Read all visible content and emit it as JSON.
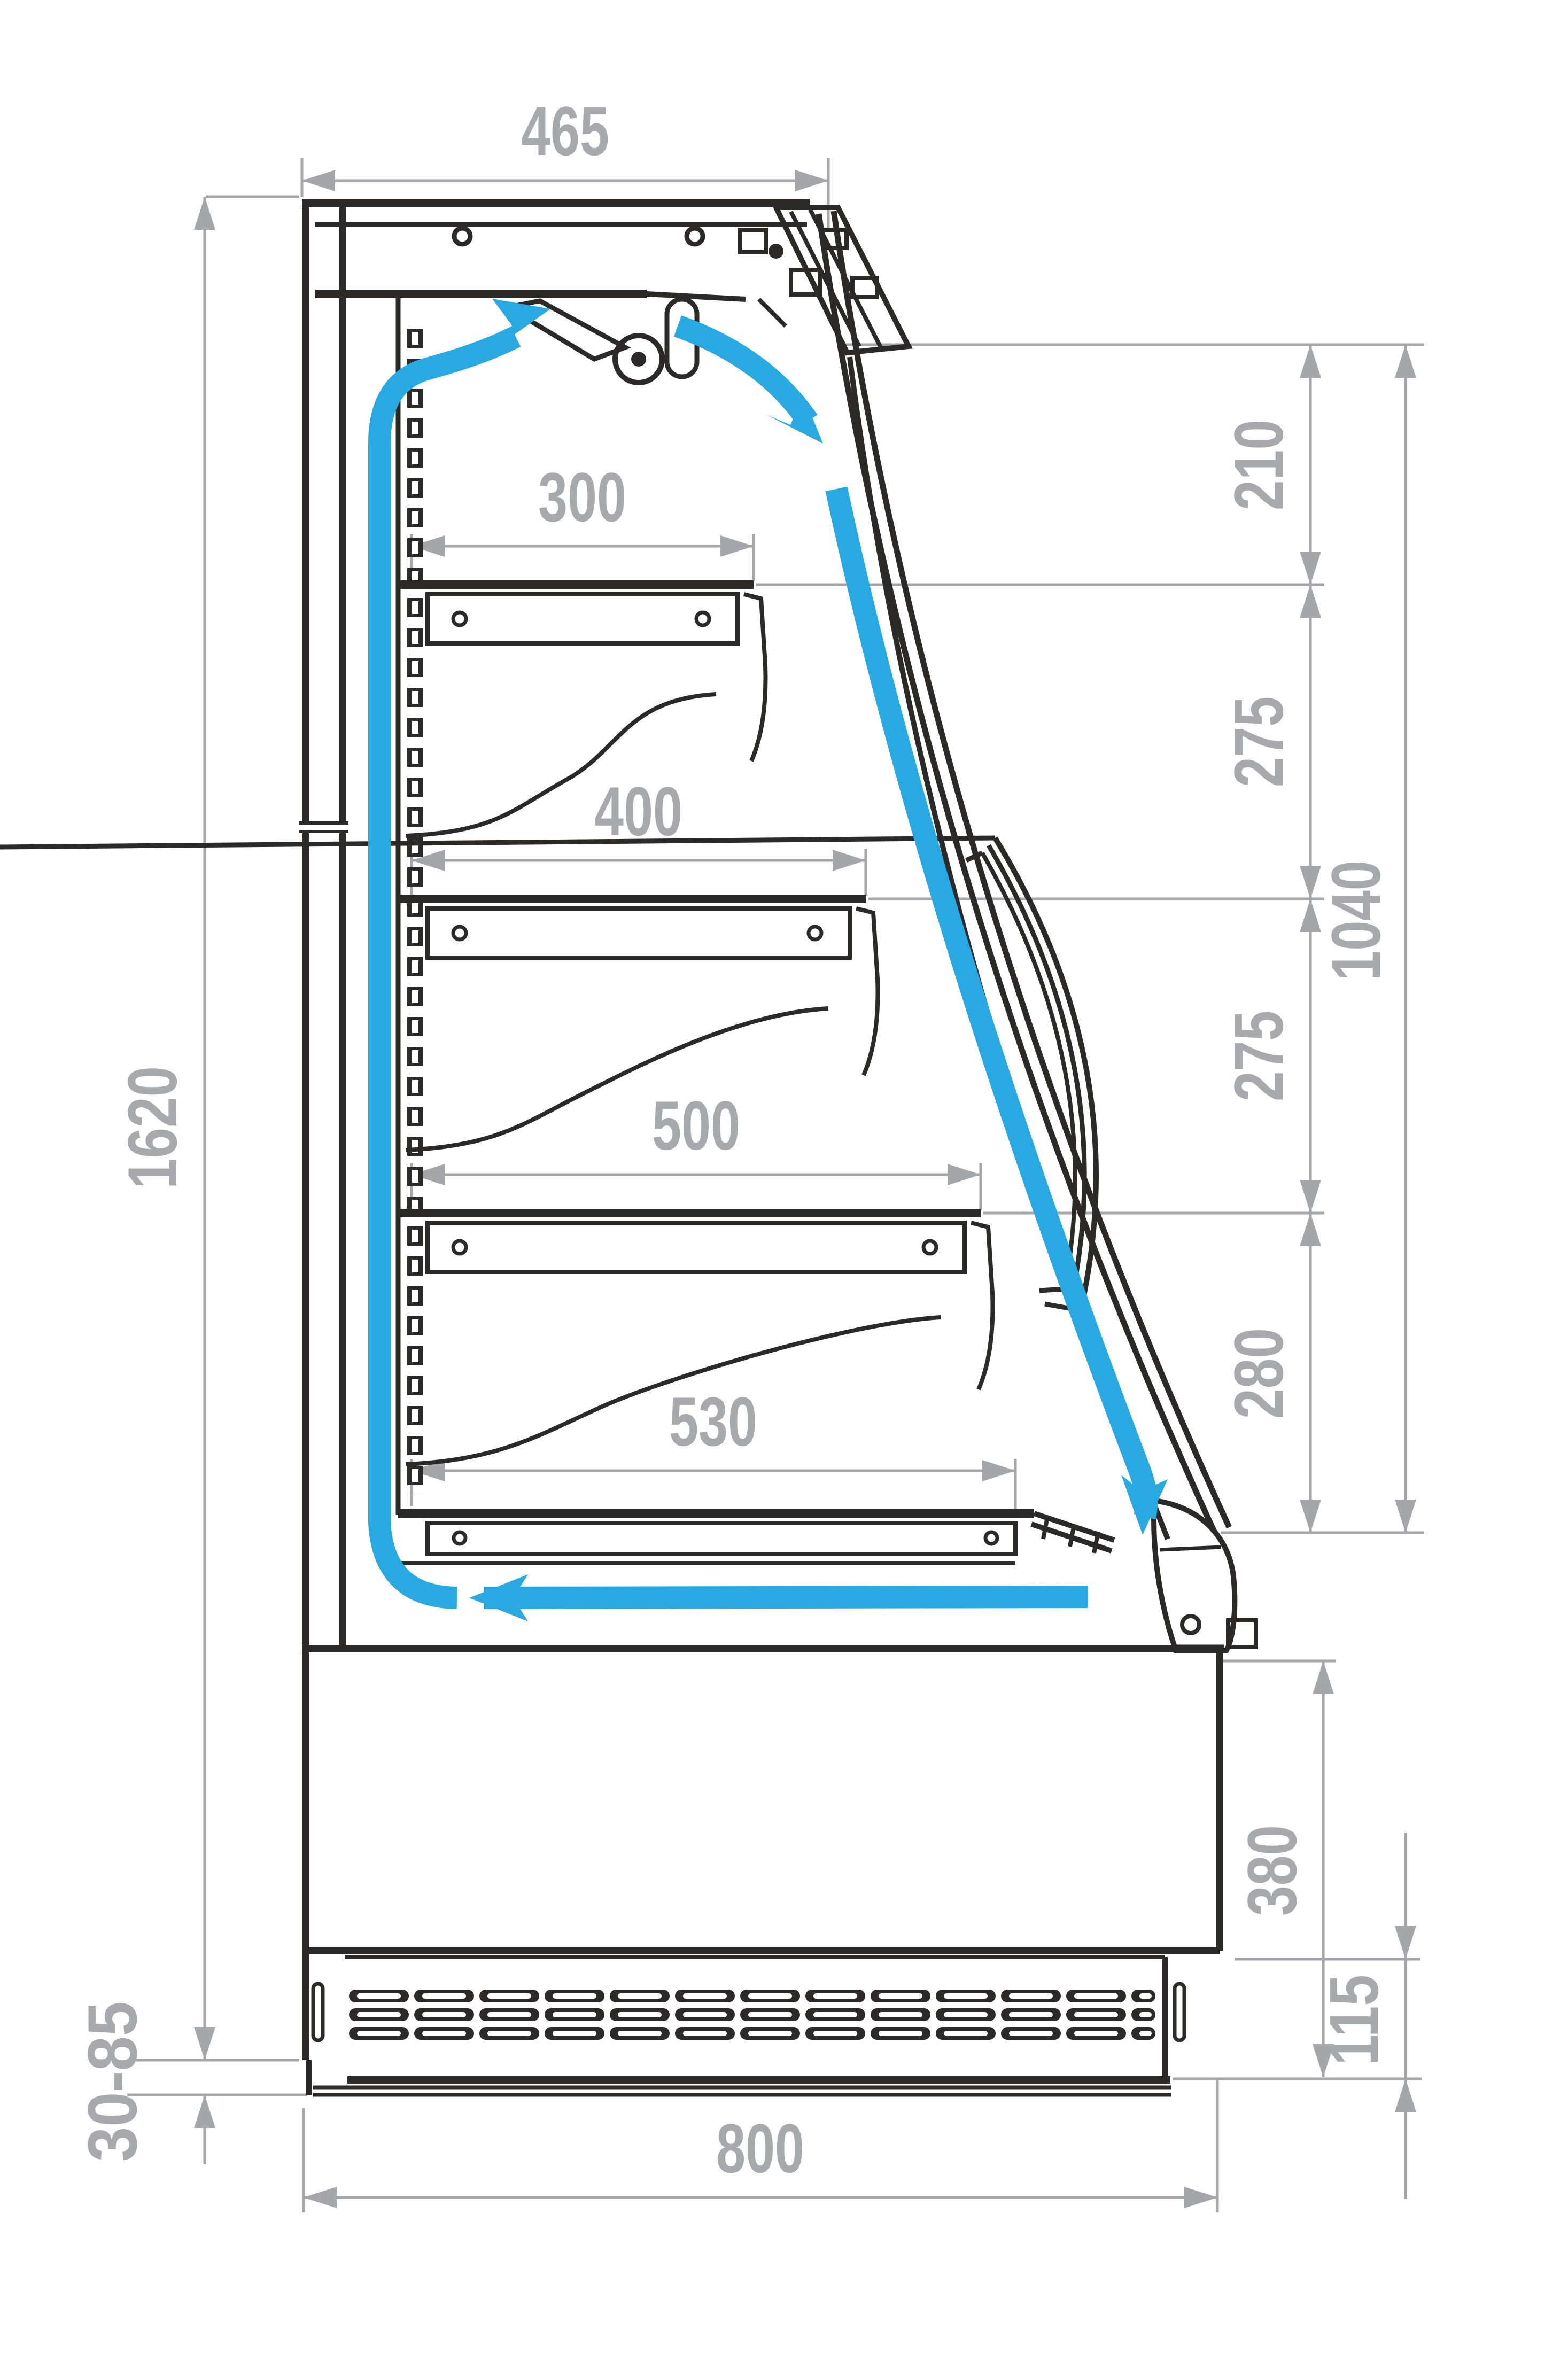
{
  "drawing": {
    "type": "technical-section-diagram",
    "subject": "open-front refrigerated display case, side cross-section with air circulation",
    "units": "mm",
    "colors": {
      "linework": "#2b2a29",
      "dimension_gray": "#a4a6a9",
      "dimension_text": "#a7a9ac",
      "airflow_blue": "#29a9e1",
      "background": "#ffffff"
    },
    "dimensions": {
      "top_depth": {
        "value": "465",
        "orientation": "horizontal",
        "meaning": "canopy top depth"
      },
      "overall_height": {
        "value": "1620",
        "orientation": "vertical",
        "meaning": "overall height without feet"
      },
      "gap_canopy_shelf1": {
        "value": "210",
        "orientation": "vertical",
        "meaning": "air outlet to shelf 1"
      },
      "gap_shelf1_shelf2": {
        "value": "275",
        "orientation": "vertical",
        "meaning": "shelf 1 to shelf 2"
      },
      "gap_shelf2_shelf3": {
        "value": "275",
        "orientation": "vertical",
        "meaning": "shelf 2 to shelf 3"
      },
      "gap_shelf3_deck": {
        "value": "280",
        "orientation": "vertical",
        "meaning": "shelf 3 to deck"
      },
      "opening_height": {
        "value": "1040",
        "orientation": "vertical",
        "meaning": "display opening height"
      },
      "shelf1_depth": {
        "value": "300",
        "orientation": "horizontal",
        "meaning": "shelf 1 depth"
      },
      "shelf2_depth": {
        "value": "400",
        "orientation": "horizontal",
        "meaning": "shelf 2 depth"
      },
      "shelf3_depth": {
        "value": "500",
        "orientation": "horizontal",
        "meaning": "shelf 3 depth"
      },
      "deck_depth": {
        "value": "530",
        "orientation": "horizontal",
        "meaning": "bottom deck depth"
      },
      "base_height": {
        "value": "380",
        "orientation": "vertical",
        "meaning": "base section height"
      },
      "grille_height": {
        "value": "115",
        "orientation": "vertical",
        "meaning": "ventilation grille height"
      },
      "foot_range": {
        "value": "30-85",
        "orientation": "vertical",
        "meaning": "adjustable foot height"
      },
      "overall_depth": {
        "value": "800",
        "orientation": "horizontal",
        "meaning": "overall depth"
      }
    },
    "airflow": {
      "description": "closed air curtain loop: up the rear duct, discharged at canopy, down along glass front, returned through bottom duct",
      "arrow_count": 4
    }
  }
}
